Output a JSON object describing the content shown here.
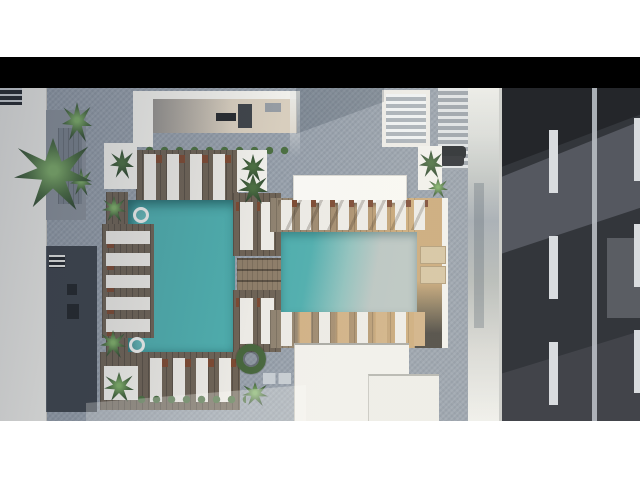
{
  "page": {
    "kind": "architectural aerial render displayed letterboxed",
    "subject": "Top-down 3D rendering of a rooftop amenity deck: two connected swimming pools with wooden decks and white sun loungers, planters and palms, bordered by white buildings on the left/top and a two-lane asphalt road on the right"
  },
  "scene": {
    "pools": [
      "left-pool-vertical",
      "right-pool-horizontal"
    ],
    "bridge": "wood-plank bridge over channel connecting the pools",
    "lounger_counts": {
      "left_pool_top_row": 4,
      "left_pool_jetty_row": 5,
      "left_pool_bottom_row": 4,
      "center_upper_pair": 2,
      "center_lower_pair": 2,
      "right_pool_top_row": 8,
      "right_pool_bottom_row": 8,
      "right_end_tan_pair": 2
    },
    "road": {
      "lanes": 2,
      "visible_dashes_per_lane": 3,
      "divider": "continuous light line"
    },
    "plants": [
      "large-palm",
      "corner-palms",
      "hedge-rows",
      "white-planter-boxes",
      "ring-topiary-wreath",
      "shrubs"
    ],
    "floats": 2
  },
  "colors": {
    "page-white": "#ffffff",
    "letterbox-black": "#000000",
    "paver": "#97a0ab",
    "roof-white": "#f1f0eb",
    "roof-bright": "#f8f7f3",
    "wall-charcoal": "#3d434b",
    "wall-dark": "#23272c",
    "recess-gray": "#8b929b",
    "patio-tan": "#d8cebe",
    "wood-dark": "#6e6356",
    "wood-mid": "#8d7d69",
    "wood-sun": "#caa878",
    "pool-teal": "#4fadad",
    "pool-pale": "#b9c4c1",
    "lounger-white": "#eceae5",
    "lounger-brown": "#7c4a33",
    "green-dark": "#2f4630",
    "green-mid": "#4c6f42",
    "green-light": "#7fae68",
    "road-dark": "#33363b",
    "road-shadow": "#24262a",
    "road-light": "#555860",
    "marking": "#d9dcdf",
    "divider": "#b6bbc1",
    "sidewalk": "#d6d6d2"
  }
}
